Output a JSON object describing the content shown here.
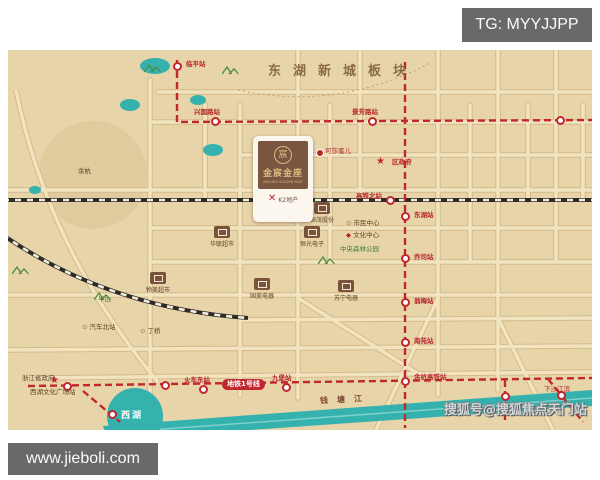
{
  "overlays": {
    "tg_badge": "TG: MYYJJPP",
    "url_watermark": "www.jieboli.com",
    "sohu_watermark": "搜狐号@搜狐焦点天门站"
  },
  "map": {
    "banner_text": "东湖新城板块",
    "project": {
      "name": "金宸金座",
      "name_en": "JINCHEN GOLDEN SEAT",
      "emblem": "宸",
      "developer_mark": "✕",
      "developer": "K2地产"
    },
    "metro_badge": "地铁1号线",
    "west_lake_label": "西湖",
    "river_label": "钱塘江",
    "colors": {
      "map_bg": "#e8d4a9",
      "road_fill": "#f2e4bf",
      "road_casing": "#d4ba8d",
      "metro_red": "#c1272d",
      "water_teal": "#35b1ae",
      "railway_black": "#2e2a26",
      "label_dark": "#5b4226",
      "label_red": "#b5272b",
      "label_green": "#3f7d3f",
      "block_brown": "#7a5338",
      "banner_brown": "#8a6b46",
      "badge_gray": "#696969",
      "yuhang_fill": "#dfcb9e"
    },
    "roads": {
      "segments": [
        [
          142,
          30,
          142,
          345
        ],
        [
          197,
          55,
          197,
          150
        ],
        [
          232,
          55,
          232,
          345
        ],
        [
          290,
          0,
          290,
          348
        ],
        [
          352,
          0,
          352,
          150
        ],
        [
          322,
          55,
          322,
          212
        ],
        [
          430,
          0,
          430,
          345
        ],
        [
          462,
          55,
          462,
          212
        ],
        [
          490,
          0,
          490,
          340
        ],
        [
          520,
          55,
          520,
          150
        ],
        [
          548,
          0,
          548,
          212
        ],
        [
          575,
          55,
          575,
          150
        ],
        [
          150,
          42,
          584,
          42
        ],
        [
          142,
          72,
          584,
          72
        ],
        [
          232,
          105,
          584,
          105
        ],
        [
          0,
          140,
          584,
          140
        ],
        [
          142,
          178,
          584,
          178
        ],
        [
          142,
          212,
          584,
          212
        ],
        [
          0,
          245,
          584,
          245
        ],
        [
          232,
          270,
          584,
          268
        ],
        [
          0,
          300,
          584,
          296
        ],
        [
          30,
          328,
          584,
          322
        ],
        [
          290,
          248,
          420,
          330
        ],
        [
          430,
          248,
          368,
          380
        ],
        [
          490,
          268,
          545,
          380
        ]
      ],
      "paths": [
        "M8,40 Q40,200 150,332"
      ]
    },
    "boundaries": [
      "M230,40 Q330,62 424,12"
    ],
    "railways": [
      "M-5,150 L590,150",
      "M-5,185 Q100,258 240,268"
    ],
    "metro_lines": [
      "M169,10 L169,72 L584,70",
      "M397,12 L397,378",
      "M20,336 L584,328",
      "M75,341 L112,372",
      "M497,330 L497,374",
      "M540,329 L575,372"
    ],
    "stations": [
      {
        "x": 169,
        "y": 16,
        "label": "临平站",
        "lx": 178,
        "ly": 11
      },
      {
        "x": 207,
        "y": 71,
        "label": "兴国路站",
        "lx": 186,
        "ly": 59
      },
      {
        "x": 364,
        "y": 71,
        "label": "景芳路站",
        "lx": 344,
        "ly": 59
      },
      {
        "x": 552,
        "y": 70,
        "label": "",
        "lx": 0,
        "ly": 0
      },
      {
        "x": 382,
        "y": 150,
        "label": "高铁北站",
        "lx": 348,
        "ly": 143
      },
      {
        "x": 397,
        "y": 166,
        "label": "东湖站",
        "lx": 406,
        "ly": 162
      },
      {
        "x": 397,
        "y": 208,
        "label": "乔司站",
        "lx": 406,
        "ly": 204
      },
      {
        "x": 397,
        "y": 252,
        "label": "翁梅站",
        "lx": 406,
        "ly": 248
      },
      {
        "x": 397,
        "y": 292,
        "label": "南苑站",
        "lx": 406,
        "ly": 288
      },
      {
        "x": 397,
        "y": 331,
        "label": "余杭高铁站",
        "lx": 406,
        "ly": 324
      },
      {
        "x": 195,
        "y": 339,
        "label": "火车东站",
        "lx": 176,
        "ly": 327
      },
      {
        "x": 278,
        "y": 337,
        "label": "九堡站",
        "lx": 264,
        "ly": 325
      },
      {
        "x": 59,
        "y": 336,
        "label": "",
        "lx": 0,
        "ly": 0
      },
      {
        "x": 157,
        "y": 335,
        "label": "",
        "lx": 0,
        "ly": 0
      },
      {
        "x": 104,
        "y": 364,
        "label": "",
        "lx": 0,
        "ly": 0
      },
      {
        "x": 497,
        "y": 346,
        "label": "",
        "lx": 0,
        "ly": 0
      },
      {
        "x": 553,
        "y": 345,
        "label": "",
        "lx": 0,
        "ly": 0
      }
    ],
    "stars": [
      {
        "x": 373,
        "y": 112
      },
      {
        "x": 47,
        "y": 331
      }
    ],
    "blocks": [
      {
        "x": 306,
        "y": 152,
        "label": "恒茂股份"
      },
      {
        "x": 296,
        "y": 176,
        "label": "恒光电子"
      },
      {
        "x": 206,
        "y": 176,
        "label": "华联超市"
      },
      {
        "x": 142,
        "y": 222,
        "label": "物美超市"
      },
      {
        "x": 330,
        "y": 230,
        "label": "苏宁电器"
      },
      {
        "x": 246,
        "y": 228,
        "label": "国美电器"
      }
    ],
    "pois": [
      {
        "x": 308,
        "y": 99,
        "label": "可莎蜜儿",
        "lx": 317,
        "ly": 98
      }
    ],
    "labels": [
      {
        "x": 338,
        "y": 170,
        "t": "市民中心",
        "c": "dark",
        "icon": "⊙",
        "ic": "#8a6f4d"
      },
      {
        "x": 338,
        "y": 182,
        "t": "文化中心",
        "c": "dark",
        "icon": "◆",
        "ic": "#b5272b"
      },
      {
        "x": 332,
        "y": 196,
        "t": "中央森林公园",
        "c": "green"
      },
      {
        "x": 90,
        "y": 246,
        "t": "半山",
        "c": "green"
      },
      {
        "x": 74,
        "y": 274,
        "t": "汽车北站",
        "c": "dark",
        "icon": "⊙",
        "ic": "#8a6f4d"
      },
      {
        "x": 132,
        "y": 278,
        "t": "丁桥",
        "c": "dark",
        "icon": "⊙",
        "ic": "#8a6f4d"
      },
      {
        "x": 14,
        "y": 325,
        "t": "浙江省政府",
        "c": "dark"
      },
      {
        "x": 22,
        "y": 339,
        "t": "西湖文化广场站",
        "c": "dark"
      },
      {
        "x": 536,
        "y": 336,
        "t": "下沙江滨",
        "c": "red"
      },
      {
        "x": 384,
        "y": 109,
        "t": "区政府",
        "c": "red",
        "bold": true
      }
    ],
    "hills": [
      {
        "x": 214,
        "y": 10
      },
      {
        "x": 86,
        "y": 236
      },
      {
        "x": 310,
        "y": 200
      },
      {
        "x": 4,
        "y": 210
      },
      {
        "x": 136,
        "y": 8
      }
    ],
    "lakes": [
      [
        147,
        16,
        15,
        8
      ],
      [
        122,
        55,
        10,
        6
      ],
      [
        190,
        50,
        8,
        5
      ],
      [
        205,
        100,
        10,
        6
      ],
      [
        27,
        140,
        6,
        4
      ]
    ],
    "yuhang_circle": {
      "cx": 85,
      "cy": 125,
      "r": 54,
      "label": "余杭",
      "lx": 70,
      "ly": 118
    },
    "west_lake": {
      "cx": 127,
      "cy": 366,
      "r": 28
    },
    "river": {
      "polygon": "95,376 584,340 584,356 100,390",
      "stripe": "M100,383 L584,348"
    }
  }
}
